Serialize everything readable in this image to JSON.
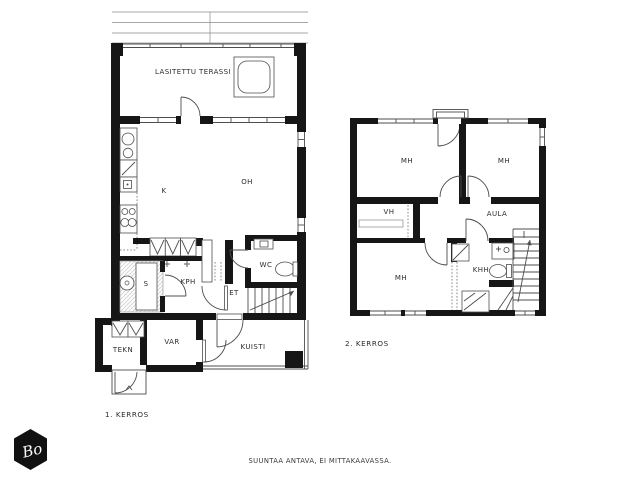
{
  "page": {
    "background": "#ffffff",
    "wall_color": "#161616",
    "line_color": "#4d4d4d",
    "footer_note": "SUUNTAA ANTAVA, EI MITTAKAAVASSA.",
    "logo": {
      "text": "Bo",
      "shape": "hexagon-icon",
      "color": "#111111"
    }
  },
  "floor1": {
    "caption": "1. KERROS",
    "rooms": {
      "terassi": {
        "label": "LASITETTU TERASSI"
      },
      "kitchen": {
        "label": "K"
      },
      "living": {
        "label": "OH"
      },
      "wc": {
        "label": "WC"
      },
      "bathroom": {
        "label": "KPH"
      },
      "sauna": {
        "label": "S"
      },
      "hall": {
        "label": "ET"
      },
      "technical": {
        "label": "TEKN"
      },
      "storage": {
        "label": "VAR"
      },
      "porch": {
        "label": "KUISTI"
      }
    }
  },
  "floor2": {
    "caption": "2. KERROS",
    "rooms": {
      "bedroom1": {
        "label": "MH"
      },
      "bedroom2": {
        "label": "MH"
      },
      "bedroom3": {
        "label": "MH"
      },
      "closet": {
        "label": "VH"
      },
      "landing": {
        "label": "AULA"
      },
      "utility": {
        "label": "KHH"
      }
    }
  }
}
